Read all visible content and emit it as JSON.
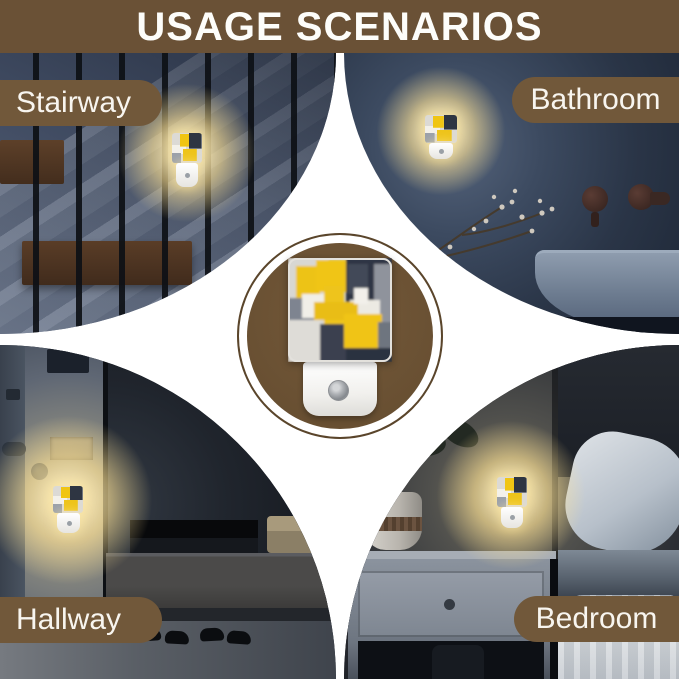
{
  "header": {
    "title": "USAGE SCENARIOS"
  },
  "scenes": [
    {
      "id": "stairway",
      "label": "Stairway",
      "position": "top-left"
    },
    {
      "id": "bathroom",
      "label": "Bathroom",
      "position": "top-right"
    },
    {
      "id": "hallway",
      "label": "Hallway",
      "position": "bottom-left"
    },
    {
      "id": "bedroom",
      "label": "Bedroom",
      "position": "bottom-right"
    }
  ],
  "product": {
    "type": "plug-in night light",
    "artwork": "abstract yellow grey white painting",
    "features": [
      "light-sensor"
    ]
  },
  "colors": {
    "brand_brown": "#6a5136",
    "label_pill_brown": "#71583a",
    "badge_disc_brown": "#6b5334",
    "glow_yellow": "#ffe196",
    "background": "#ffffff"
  }
}
